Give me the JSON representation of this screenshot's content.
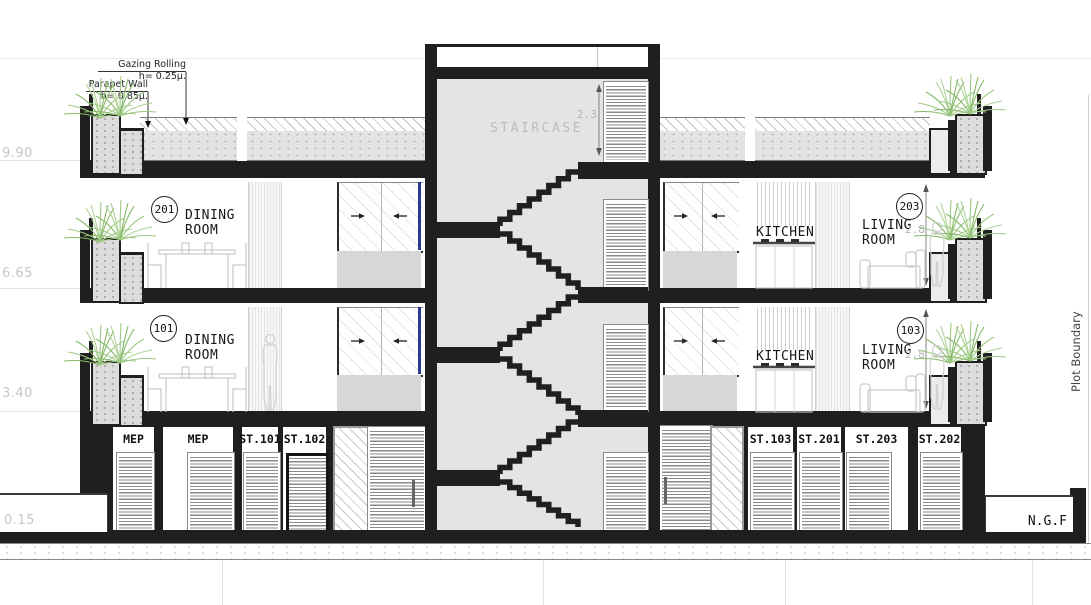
{
  "drawing": {
    "title": "Residential building cross section",
    "annotations": {
      "glazing": {
        "title": "Gazing Rolling",
        "value": "h= 0.25µ."
      },
      "parapet": {
        "title": "Parapet Wall",
        "value": "h= 0.85µ."
      }
    },
    "levels": [
      {
        "value": "9.90"
      },
      {
        "value": "6.65"
      },
      {
        "value": "3.40"
      },
      {
        "value": "0.15"
      }
    ],
    "staircase": {
      "label": "STAIRCASE",
      "height_dim": "2.3"
    },
    "floors": [
      {
        "left_unit": {
          "number": "201",
          "room": "DINING ROOM"
        },
        "right_unit": {
          "kitchen_label": "KITCHEN",
          "number": "203",
          "room": "LIVING ROOM",
          "height_dim": "2.8"
        }
      },
      {
        "left_unit": {
          "number": "101",
          "room": "DINING ROOM"
        },
        "right_unit": {
          "kitchen_label": "KITCHEN",
          "number": "103",
          "room": "LIVING ROOM",
          "height_dim": "2.8"
        }
      }
    ],
    "ground_units": [
      "MEP",
      "MEP",
      "ST.101",
      "ST.102",
      "ST.103",
      "ST.201",
      "ST.203",
      "ST.202"
    ],
    "ground_label": "N.G.F",
    "boundary_label": "Plot Boundary",
    "colors": {
      "ink": "#1f1f1f",
      "tower_gray": "#e4e4e4",
      "concrete": "#dcdcdc",
      "plant_green": "#8fbf72",
      "dim_gray": "#b4b4b4",
      "glass_blue": "#2b3990"
    }
  }
}
